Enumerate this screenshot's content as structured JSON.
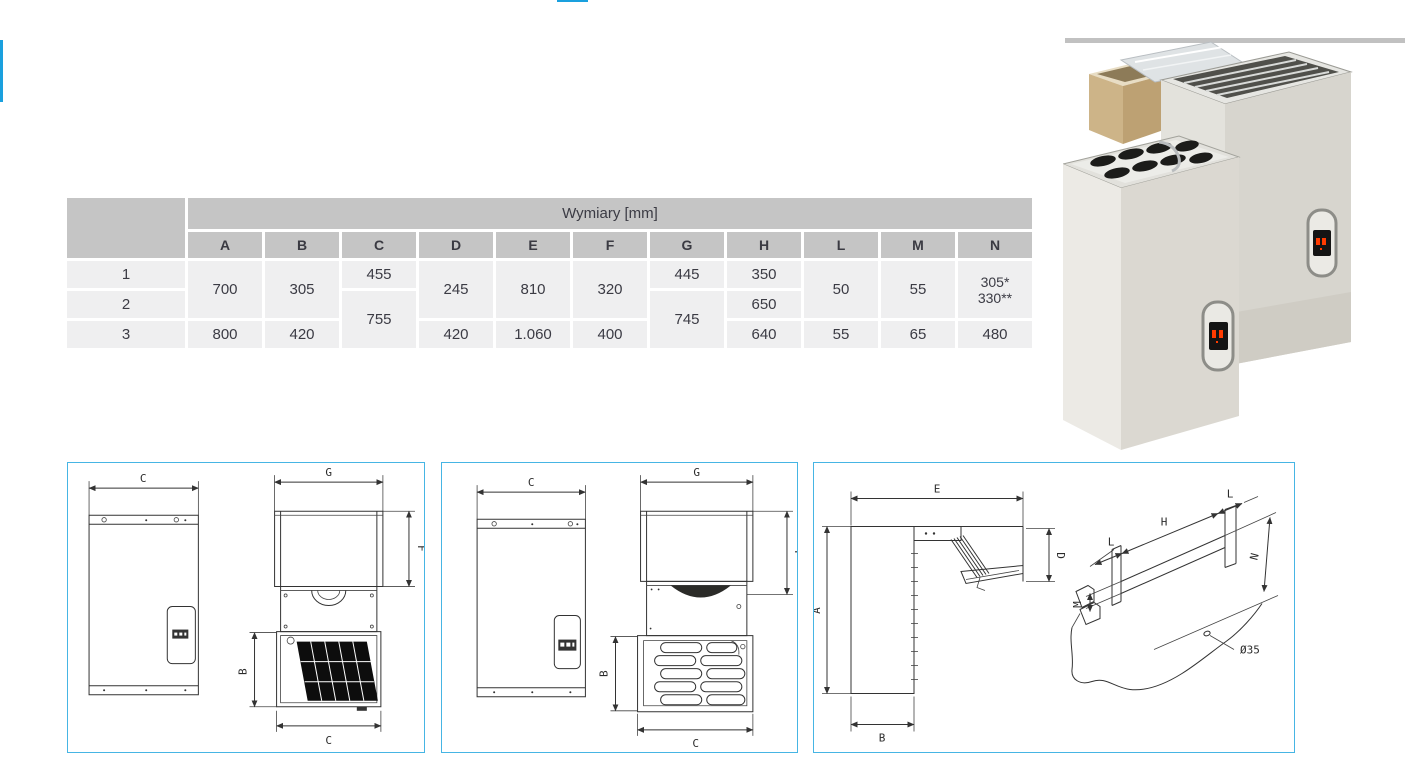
{
  "colors": {
    "accent_blue": "#1aa0de",
    "diagram_border_blue": "#46b5e4",
    "table_header_gray": "#c5c5c5",
    "table_cell_gray": "#efeff0",
    "table_text": "#3b3b44",
    "photo_topline_gray": "#c1c1c1",
    "led_red": "#ff3b00"
  },
  "table": {
    "title": "Wymiary [mm]",
    "col_headers": [
      "A",
      "B",
      "C",
      "D",
      "E",
      "F",
      "G",
      "H",
      "L",
      "M",
      "N"
    ],
    "row_labels": [
      "1",
      "2",
      "3"
    ],
    "values": {
      "A_r12": "700",
      "A_r3": "800",
      "B_r12": "305",
      "B_r3": "420",
      "C_r1": "455",
      "C_r23": "755",
      "D_r12": "245",
      "D_r3": "420",
      "E_r12": "810",
      "E_r3": "1.060",
      "F_r12": "320",
      "F_r3": "400",
      "G_r1": "445",
      "G_r23": "745",
      "H_r1": "350",
      "H_r2": "650",
      "H_r3": "640",
      "L_r12": "50",
      "L_r3": "55",
      "M_r12": "55",
      "M_r3": "65",
      "N_r12a": "305*",
      "N_r12b": "330**",
      "N_r3": "480"
    }
  },
  "diagrams": {
    "front_view_unit": {
      "c_top": "C",
      "g": "G",
      "f": "F",
      "b": "B",
      "c_bottom": "C"
    },
    "front_view_unit2": {
      "c_top": "C",
      "g": "G",
      "f": "F",
      "b": "B",
      "c_bottom": "C"
    },
    "side_view_unit": {
      "e": "E",
      "a": "A",
      "d": "D",
      "b": "B"
    },
    "wall_cutout": {
      "l_left": "L",
      "h": "H",
      "l_right": "L",
      "m": "M",
      "n": "N",
      "hole_diameter": "Ø35"
    }
  }
}
